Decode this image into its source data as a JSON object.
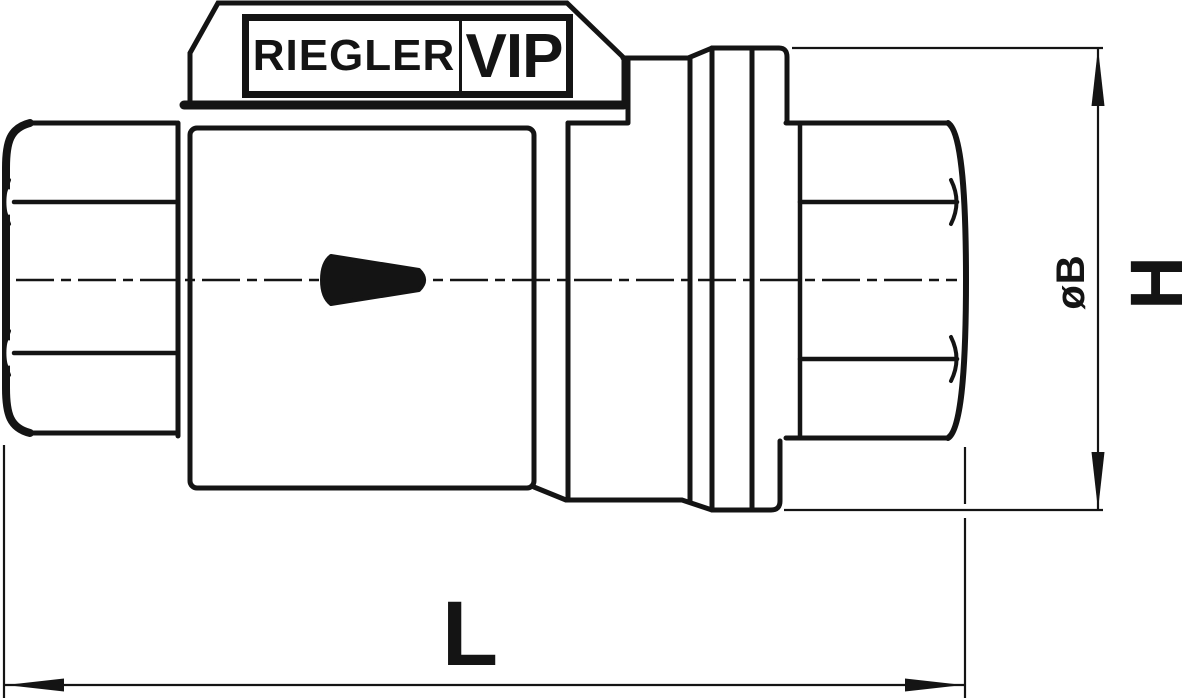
{
  "label_plate": {
    "brand": "RIEGLER",
    "series": "VIP"
  },
  "dimensions": {
    "length": "L",
    "height": "H",
    "diameter": "øB"
  },
  "flow_arrow": {
    "icon": "flow-direction-right-arrow",
    "direction": "right"
  },
  "colors": {
    "line": "#141414",
    "background": "#ffffff"
  }
}
